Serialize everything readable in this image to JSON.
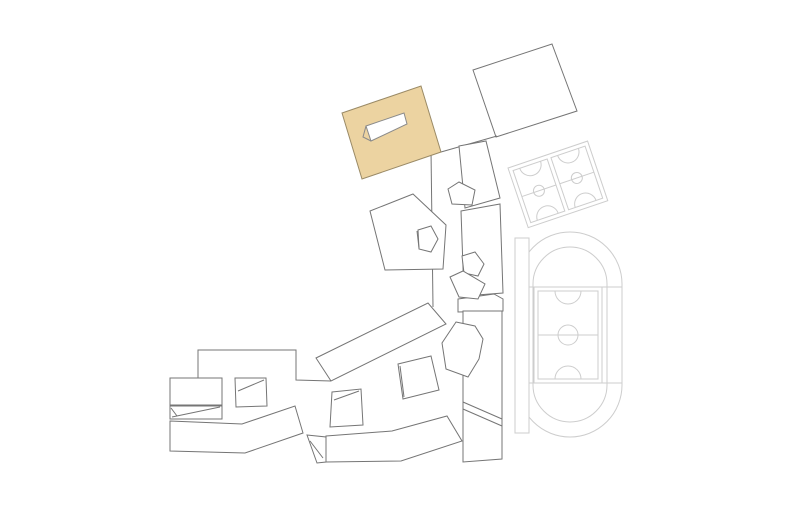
{
  "canvas": {
    "width": 790,
    "height": 526,
    "background": "#ffffff"
  },
  "plan": {
    "stroke_colors": {
      "building": "#757575",
      "sports": "#cdcdcd",
      "highlight_edge": "#9a8a66",
      "hole_edge": "#8a8a8a"
    },
    "fill_colors": {
      "white": "#ffffff",
      "highlight": "#ecd3a1"
    },
    "shapes": [
      {
        "kind": "path",
        "name": "track-outer-oval",
        "d": "M 518 284 A 52 52 0 0 1 622 284 L 622 385 A 52 52 0 0 1 518 385 Z",
        "stroke": "sports",
        "fill": "none"
      },
      {
        "kind": "path",
        "name": "track-inner-oval",
        "d": "M 533 284 A 37 37 0 0 1 607 284 L 607 385 A 37 37 0 0 1 533 385 Z",
        "stroke": "sports",
        "fill": "none"
      },
      {
        "kind": "line",
        "name": "track-straight-top-line",
        "x1": 518,
        "y1": 287,
        "x2": 622,
        "y2": 287,
        "stroke": "sports"
      },
      {
        "kind": "line",
        "name": "track-straight-bottom-line",
        "x1": 518,
        "y1": 383,
        "x2": 622,
        "y2": 383,
        "stroke": "sports"
      },
      {
        "kind": "rect",
        "name": "soccer-field-outer",
        "x": 534,
        "y": 287,
        "w": 68,
        "h": 96,
        "stroke": "sports",
        "fill": "none"
      },
      {
        "kind": "rect",
        "name": "soccer-field-inner",
        "x": 538,
        "y": 291,
        "w": 60,
        "h": 88,
        "stroke": "sports",
        "fill": "none"
      },
      {
        "kind": "line",
        "name": "soccer-field-center-line",
        "x1": 538,
        "y1": 335,
        "x2": 598,
        "y2": 335,
        "stroke": "sports"
      },
      {
        "kind": "circle",
        "name": "soccer-field-center-circle",
        "cx": 568,
        "cy": 335,
        "r": 10,
        "stroke": "sports",
        "fill": "none"
      },
      {
        "kind": "path",
        "name": "soccer-field-arc-top",
        "d": "M 555 291 A 13 13 0 0 0 581 291",
        "stroke": "sports",
        "fill": "none"
      },
      {
        "kind": "path",
        "name": "soccer-field-arc-bottom",
        "d": "M 555 379 A 13 13 0 0 1 581 379",
        "stroke": "sports",
        "fill": "none"
      },
      {
        "kind": "rect",
        "name": "grandstand-strip",
        "x": 515,
        "y": 238,
        "w": 14,
        "h": 195,
        "stroke": "sports",
        "fill": "white"
      },
      {
        "kind": "group",
        "name": "basketball-courts",
        "transform": "translate(508,168) rotate(-18.7)",
        "children": [
          {
            "kind": "rect",
            "name": "courts-outer-frame",
            "x": 0,
            "y": 0,
            "w": 84,
            "h": 63,
            "stroke": "sports",
            "fill": "white"
          },
          {
            "kind": "rect",
            "name": "basketball-court-1",
            "x": 4,
            "y": 4,
            "w": 36,
            "h": 55,
            "stroke": "sports",
            "fill": "none"
          },
          {
            "kind": "rect",
            "name": "basketball-court-2",
            "x": 44,
            "y": 4,
            "w": 36,
            "h": 55,
            "stroke": "sports",
            "fill": "none"
          },
          {
            "kind": "line",
            "name": "court-1-center-line",
            "x1": 4,
            "y1": 31.5,
            "x2": 40,
            "y2": 31.5,
            "stroke": "sports"
          },
          {
            "kind": "line",
            "name": "court-2-center-line",
            "x1": 44,
            "y1": 31.5,
            "x2": 80,
            "y2": 31.5,
            "stroke": "sports"
          },
          {
            "kind": "circle",
            "name": "court-1-center-circle",
            "cx": 22,
            "cy": 31.5,
            "r": 5.5,
            "stroke": "sports",
            "fill": "none"
          },
          {
            "kind": "circle",
            "name": "court-2-center-circle",
            "cx": 62,
            "cy": 31.5,
            "r": 5.5,
            "stroke": "sports",
            "fill": "none"
          },
          {
            "kind": "path",
            "name": "court-1-arc-top",
            "d": "M 11 4 A 11 11 0 0 0 33 4",
            "stroke": "sports",
            "fill": "none"
          },
          {
            "kind": "path",
            "name": "court-1-arc-bottom",
            "d": "M 11 59 A 11 11 0 0 1 33 59",
            "stroke": "sports",
            "fill": "none"
          },
          {
            "kind": "path",
            "name": "court-2-arc-top",
            "d": "M 51 4 A 11 11 0 0 0 73 4",
            "stroke": "sports",
            "fill": "none"
          },
          {
            "kind": "path",
            "name": "court-2-arc-bottom",
            "d": "M 51 59 A 11 11 0 0 1 73 59",
            "stroke": "sports",
            "fill": "none"
          }
        ]
      },
      {
        "kind": "polygon",
        "name": "building-ne-rect",
        "points": "473,70 552,44 577,111 496,137",
        "stroke": "building",
        "fill": "white"
      },
      {
        "kind": "line",
        "name": "walkway-ne-line",
        "x1": 441,
        "y1": 152,
        "x2": 497,
        "y2": 136,
        "stroke": "building"
      },
      {
        "kind": "line",
        "name": "walkway-central-line",
        "x1": 431,
        "y1": 150,
        "x2": 433,
        "y2": 307,
        "stroke": "building"
      },
      {
        "kind": "polygon",
        "name": "building-north-trapezoid",
        "points": "459,146 486,141 500,198 465,208",
        "stroke": "building",
        "fill": "white"
      },
      {
        "kind": "polygon",
        "name": "building-mid-column",
        "points": "461,211 500,204 503,293 464,296",
        "stroke": "building",
        "fill": "white"
      },
      {
        "kind": "polygon",
        "name": "building-connector-band",
        "points": "458,299 494,294 503,299 503,311 458,312",
        "stroke": "building",
        "fill": "white"
      },
      {
        "kind": "polygon",
        "name": "building-right-column",
        "points": "463,311 502,311 502,459 463,462",
        "stroke": "building",
        "fill": "white"
      },
      {
        "kind": "line",
        "name": "right-column-walk-line-1",
        "x1": 463,
        "y1": 402,
        "x2": 502,
        "y2": 419,
        "stroke": "building"
      },
      {
        "kind": "line",
        "name": "right-column-walk-line-2",
        "x1": 463,
        "y1": 409,
        "x2": 502,
        "y2": 426,
        "stroke": "building"
      },
      {
        "kind": "polygon",
        "name": "building-pentagon-north",
        "points": "448,189 459,182 475,190 472,205 452,204",
        "stroke": "building",
        "fill": "white"
      },
      {
        "kind": "polygon",
        "name": "building-pentagon-mid-1",
        "points": "462,256 475,252 484,264 478,276 464,273",
        "stroke": "building",
        "fill": "white"
      },
      {
        "kind": "polygon",
        "name": "building-pentagon-mid-2",
        "points": "450,277 463,271 485,284 478,299 459,297",
        "stroke": "building",
        "fill": "white"
      },
      {
        "kind": "polygon",
        "name": "building-pentagon-large",
        "points": "370,211 413,194 446,225 443,269 385,270",
        "stroke": "building",
        "fill": "white"
      },
      {
        "kind": "polygon",
        "name": "courtyard-pentagon",
        "points": "418,230 431,226 438,239 431,252 419,249",
        "stroke": "building",
        "fill": "white"
      },
      {
        "kind": "line",
        "name": "courtyard-pentagon-fold-line",
        "x1": 417,
        "y1": 231,
        "x2": 419,
        "y2": 248,
        "stroke": "building"
      },
      {
        "kind": "polygon",
        "name": "building-pentagon-se",
        "points": "456,322 475,326 483,339 479,359 468,377 446,369 442,343",
        "stroke": "building",
        "fill": "white"
      },
      {
        "kind": "polygon",
        "name": "building-angled-mid",
        "points": "316,358 428,303 446,324 331,381",
        "stroke": "building",
        "fill": "white"
      },
      {
        "kind": "polyline",
        "name": "site-outline-nw",
        "points": "198,378 198,350 296,350 296,380 331,381",
        "stroke": "building",
        "fill": "none"
      },
      {
        "kind": "rect",
        "name": "building-west-rect",
        "x": 170,
        "y": 378,
        "w": 52,
        "h": 27,
        "stroke": "building",
        "fill": "white"
      },
      {
        "kind": "polygon",
        "name": "building-west-strip",
        "points": "170,406 222,406 222,419 170,419",
        "stroke": "building",
        "fill": "white"
      },
      {
        "kind": "line",
        "name": "west-strip-fold-line",
        "x1": 172,
        "y1": 417,
        "x2": 220,
        "y2": 407,
        "stroke": "building"
      },
      {
        "kind": "line",
        "name": "west-strip-notch-line",
        "x1": 171,
        "y1": 408,
        "x2": 177,
        "y2": 416,
        "stroke": "building"
      },
      {
        "kind": "polygon",
        "name": "courtyard-west",
        "points": "235,378 266,378 267,406 236,407",
        "stroke": "building",
        "fill": "white"
      },
      {
        "kind": "line",
        "name": "courtyard-west-fold-line",
        "x1": 264,
        "y1": 380,
        "x2": 238,
        "y2": 391,
        "stroke": "building"
      },
      {
        "kind": "polygon",
        "name": "courtyard-mid-left",
        "points": "332,392 361,389 363,425 330,427",
        "stroke": "building",
        "fill": "white"
      },
      {
        "kind": "line",
        "name": "courtyard-mid-left-fold-line",
        "x1": 359,
        "y1": 391,
        "x2": 334,
        "y2": 400,
        "stroke": "building"
      },
      {
        "kind": "polygon",
        "name": "courtyard-center",
        "points": "398,364 431,356 439,390 403,399",
        "stroke": "building",
        "fill": "white"
      },
      {
        "kind": "line",
        "name": "courtyard-center-fold-line",
        "x1": 400,
        "y1": 366,
        "x2": 404,
        "y2": 397,
        "stroke": "building"
      },
      {
        "kind": "polygon",
        "name": "building-band-upper",
        "points": "170,421 242,424 295,406 303,433 245,453 170,451",
        "stroke": "building",
        "fill": "white"
      },
      {
        "kind": "polygon",
        "name": "building-sw-quad",
        "points": "307,435 326,437 326,462 317,463",
        "stroke": "building",
        "fill": "white"
      },
      {
        "kind": "line",
        "name": "sw-quad-fold-line",
        "x1": 310,
        "y1": 441,
        "x2": 323,
        "y2": 458,
        "stroke": "building"
      },
      {
        "kind": "polygon",
        "name": "building-band-lower",
        "points": "326,436 392,431 447,416 462,441 401,461 326,462",
        "stroke": "building",
        "fill": "white"
      },
      {
        "kind": "polygon",
        "name": "highlighted-building",
        "points": "342,113 421,86 441,152 362,179",
        "stroke": "highlight_edge",
        "fill": "highlight",
        "interactable": true
      },
      {
        "kind": "polygon",
        "name": "highlighted-building-courtyard",
        "points": "366,126 404,113 407,124 371,141",
        "stroke": "hole_edge",
        "fill": "white"
      },
      {
        "kind": "polyline",
        "name": "highlighted-courtyard-fold-line",
        "points": "366,126 363,137 371,141",
        "stroke": "hole_edge",
        "fill": "none"
      }
    ]
  }
}
